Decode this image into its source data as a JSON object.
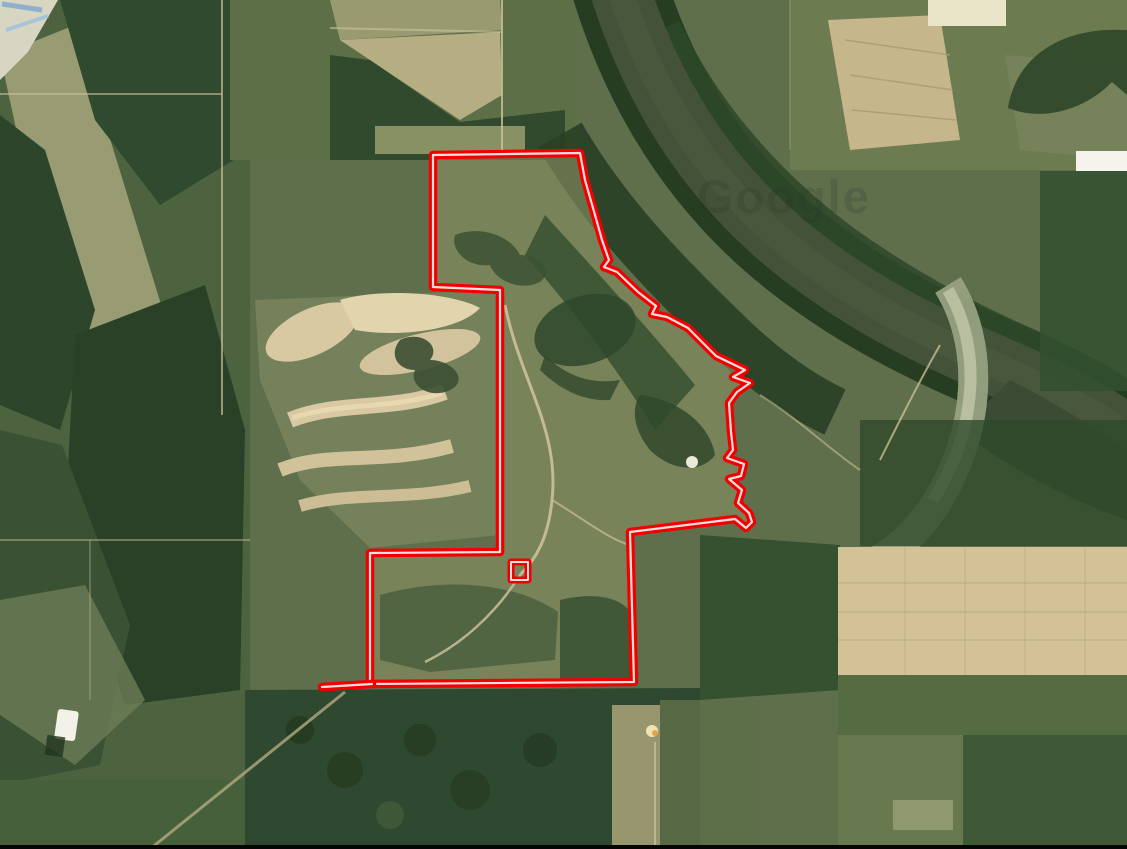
{
  "map": {
    "type": "satellite-imagery",
    "watermark_text": "Google",
    "colors": {
      "boundary": "#f20000",
      "boundary_core": "#ffdede",
      "letterbox_bar": "#060606",
      "interior_fill": "#8b9162"
    },
    "boundary": {
      "main_points": "433,155 580,153 585,180 597,222 602,240 609,260 604,267 617,272 638,292 656,306 652,314 667,317 688,328 716,356 745,370 733,377 750,383 737,392 729,403 731,432 733,450 727,458 744,464 741,476 729,479 742,490 738,503 749,513 752,522 746,528 735,519 630,532 634,682 370,684 370,553 500,552 500,290 433,287",
      "tail_points": "322,687 372,684",
      "outer_width": 8.5,
      "core_width": 2.2,
      "marker_square": {
        "x": 511,
        "y": 562,
        "w": 17,
        "h": 18,
        "outer_width": 7,
        "core_width": 2
      }
    }
  }
}
